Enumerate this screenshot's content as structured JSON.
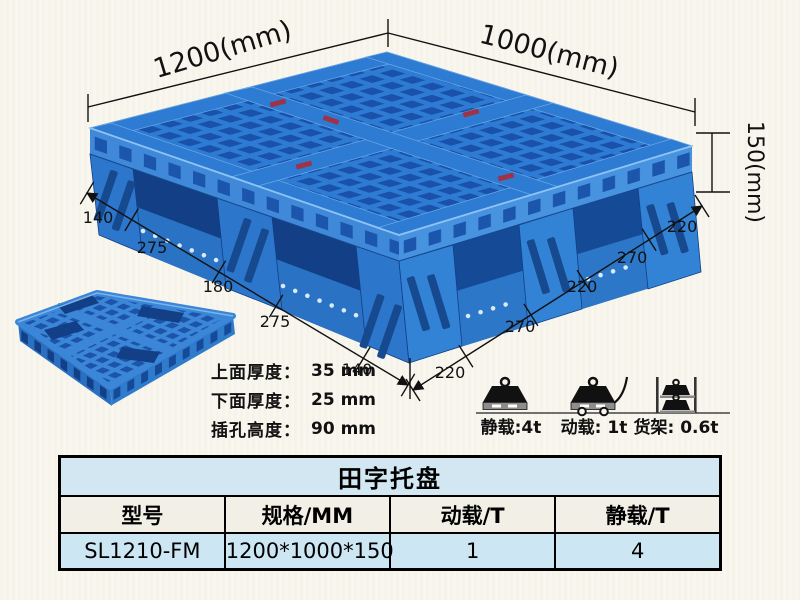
{
  "page": {
    "background": "#f8f6ee"
  },
  "pallet_diagram": {
    "dim_top_left": "1200(mm)",
    "dim_top_right": "1000(mm)",
    "dim_height": "150(mm)",
    "left_edge_dims": [
      "140",
      "275",
      "180",
      "275",
      "140"
    ],
    "right_edge_dims": [
      "220",
      "270",
      "220",
      "270",
      "220"
    ]
  },
  "thickness_specs": [
    {
      "label": "上面厚度：",
      "value": "35 mm"
    },
    {
      "label": "下面厚度：",
      "value": "25 mm"
    },
    {
      "label": "插孔高度：",
      "value": "90 mm"
    }
  ],
  "load_ratings": [
    {
      "icon": "static-load-icon",
      "label": "静载:4t"
    },
    {
      "icon": "dynamic-load-icon",
      "label": "动载: 1t"
    },
    {
      "icon": "rack-load-icon",
      "label": "货架: 0.6t"
    }
  ],
  "spec_table": {
    "title": "田字托盘",
    "headers": [
      "型号",
      "规格/MM",
      "动载/T",
      "静载/T"
    ],
    "rows": [
      [
        "SL1210-FM",
        "1200*1000*150",
        "1",
        "4"
      ]
    ]
  },
  "colors": {
    "pallet_blue": "#2d7bd2",
    "pallet_dark_blue": "#1a52ab",
    "pallet_light_blue": "#4893df",
    "table_title_bg": "#d3e7f2",
    "table_header_bg": "#f2efe6",
    "table_row_bg": "#cde6f3",
    "tag_red": "#9e3347"
  }
}
